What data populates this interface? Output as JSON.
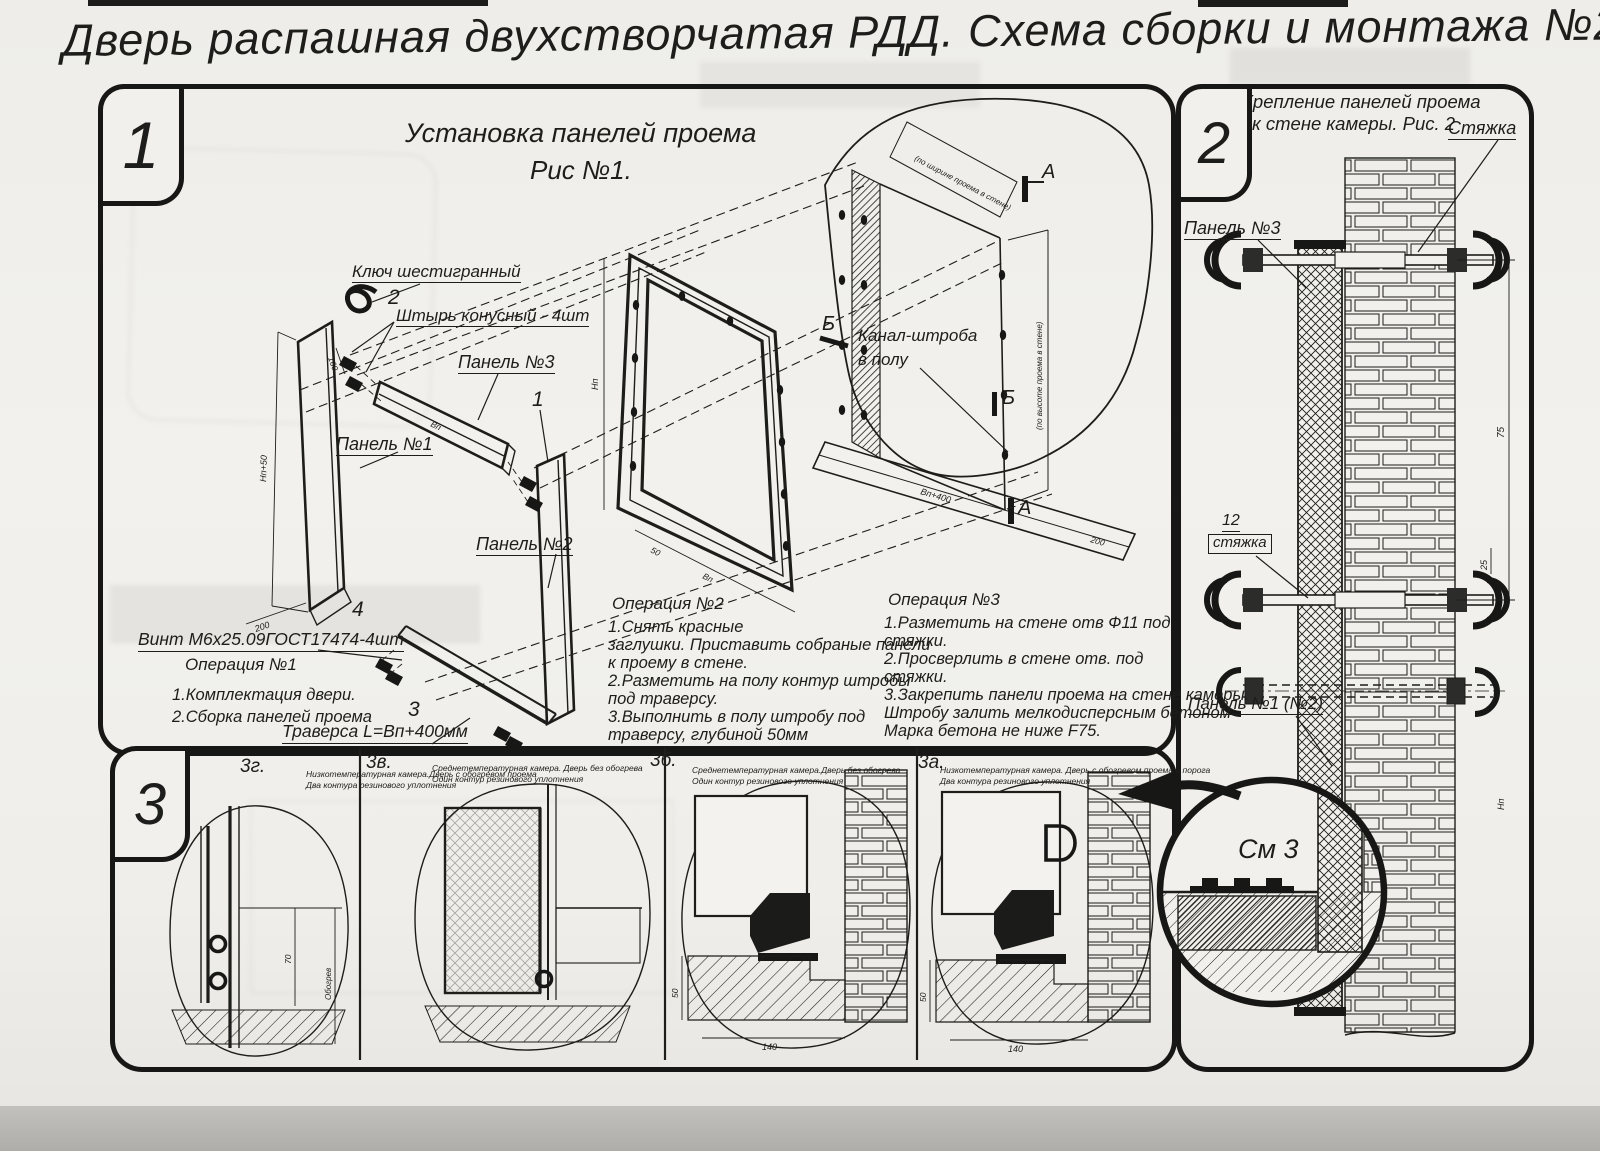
{
  "title": "Дверь распашная двухстворчатая РДД.  Схема сборки и монтажа №2",
  "section1": {
    "badge": "1",
    "fig_title_1": "Установка панелей проема",
    "fig_title_2": "Рис №1.",
    "labels": {
      "hex_key": "Ключ шестигранный",
      "pin": "Штырь конусный - 4шт",
      "panel1": "Панель №1",
      "panel2": "Панель №2",
      "panel3": "Панель №3",
      "screw": "Винт М6х25.09ГОСТ17474-4шт",
      "traverse": "Траверса  L=Bп+400мм",
      "channel_1": "Канал-штроба",
      "channel_2": "в полу",
      "mark_a": "А",
      "mark_b": "Б"
    },
    "callouts": {
      "c1": "1",
      "c2": "2",
      "c3": "3",
      "c4": "4"
    },
    "dims": {
      "np50": "Нп+50",
      "d200": "200",
      "d160": "160",
      "np": "Нп",
      "vp": "Вп",
      "vp400": "Вп+400",
      "d50": "50",
      "opening_w": "(по ширине проема в стене)",
      "opening_h": "(по высоте проема в стене)"
    },
    "op1": {
      "title": "Операция №1",
      "lines": [
        "1.Комплектация двери.",
        "2.Сборка панелей проема"
      ]
    },
    "op2": {
      "title": "Операция №2",
      "lines": [
        "1.Снять красные",
        "заглушки. Приставить собраные панели",
        "к проему в стене.",
        "2.Разметить на полу контур штробы",
        "под траверсу.",
        "3.Выполнить в полу штробу под",
        "траверсу, глубиной 50мм"
      ]
    },
    "op3": {
      "title": "Операция №3",
      "lines": [
        "1.Разметить на стене отв Ф11 под",
        "стяжки.",
        "2.Просверлить в стене отв.  под",
        "стяжки.",
        "3.Закрепить панели проема на стене камеры.",
        "Штробу залить мелкодисперсным бетоном",
        "Марка бетона не ниже  F75."
      ]
    }
  },
  "section2": {
    "badge": "2",
    "fig_title_1": "Крепление панелей проема",
    "fig_title_2": "к стене камеры. Рис. 2",
    "labels": {
      "tie": "Стяжка",
      "panel3": "Панель №3",
      "pos12": "12",
      "pos12_name": "стяжка",
      "panel12": "Панель №1 (№2)",
      "see3": "См 3"
    },
    "dims": {
      "d25": "25",
      "d75": "75",
      "np": "Нп"
    }
  },
  "section3": {
    "badge": "3",
    "panels": [
      {
        "id": "3г.",
        "desc1": "Низкотемпературная камера.Дверь с обогревом проема",
        "desc2": "Два контура резинового уплотнения"
      },
      {
        "id": "3в.",
        "desc1": "Среднетемпературная камера. Дверь без обогрева",
        "desc2": "Один контур резинового уплотнения"
      },
      {
        "id": "3б.",
        "desc1": "Среднетемпературная камера.Дверь без обогрева",
        "desc2": "Один контур резинового уплотнения"
      },
      {
        "id": "3а.",
        "desc1": "Низкотемпературная камера. Дверь с обогревом проема и порога",
        "desc2": "Два контура резинового уплотнения"
      }
    ],
    "dims": {
      "d140": "140",
      "d50": "50",
      "d70": "70",
      "heat": "Обогрев"
    }
  }
}
